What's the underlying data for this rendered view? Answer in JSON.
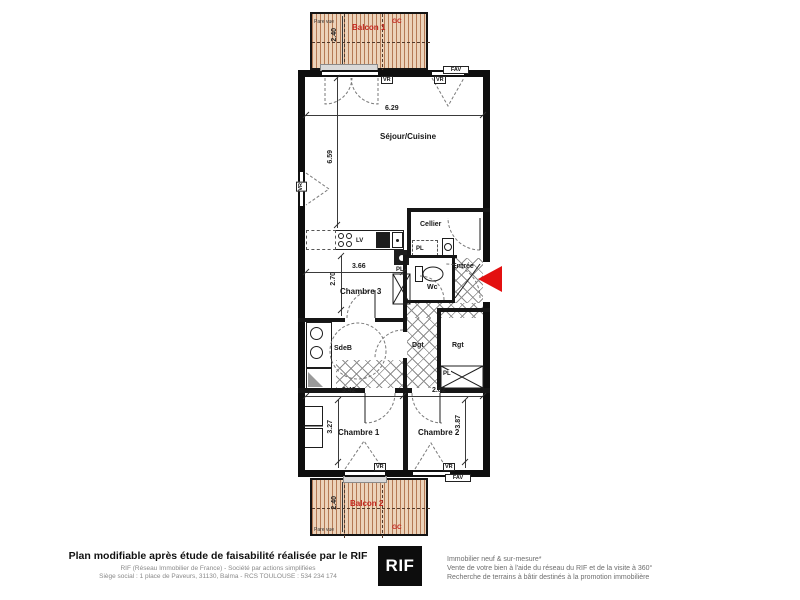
{
  "plan": {
    "rooms": {
      "sejour_cuisine": "Séjour/Cuisine",
      "cellier": "Cellier",
      "entree": "Entrée",
      "wc": "Wc",
      "chambre3": "Chambre 3",
      "sdb": "SdeB",
      "dgt": "Dgt",
      "rgt": "Rgt",
      "chambre1": "Chambre 1",
      "chambre2": "Chambre 2",
      "balcon1": "Balcon 1",
      "balcon2": "Balcon 2"
    },
    "dims": {
      "sejour_width": "6.29",
      "sejour_height": "6.59",
      "chambre3_width": "3.66",
      "chambre3_height": "2.70",
      "sdb_width": "3.42",
      "chambre2_width": "2.82",
      "chambre1_height": "3.27",
      "chambre2_height": "3.87",
      "balcon1_depth": "2.40",
      "balcon2_depth": "2.40"
    },
    "labels": {
      "vr": "VR",
      "fav": "FAV",
      "pl": "PL",
      "lv": "LV",
      "gc": "GC",
      "pare_vue": "Pare vue"
    }
  },
  "footer": {
    "title": "Plan modifiable après étude de faisabilité réalisée par le RIF",
    "company_line": "RIF (Réseau Immobilier de France) - Société par actions simplifiées",
    "address_line": "Siège social : 1 place de Paveurs, 31130, Balma - RCS TOULOUSE : 534 234 174",
    "logo_text": "RIF",
    "services": [
      "Immobilier neuf & sur-mesure*",
      "Vente de votre bien à l'aide du réseau du RIF et de la visite à 360°",
      "Recherche de terrains à bâtir destinés à la promotion immobilière"
    ]
  },
  "colors": {
    "red-text": "#c3271f",
    "arrow-red": "#e31010",
    "wall": "#0e0e0e",
    "brick-a": "#b57a55",
    "brick-b": "#ecd3ba"
  }
}
